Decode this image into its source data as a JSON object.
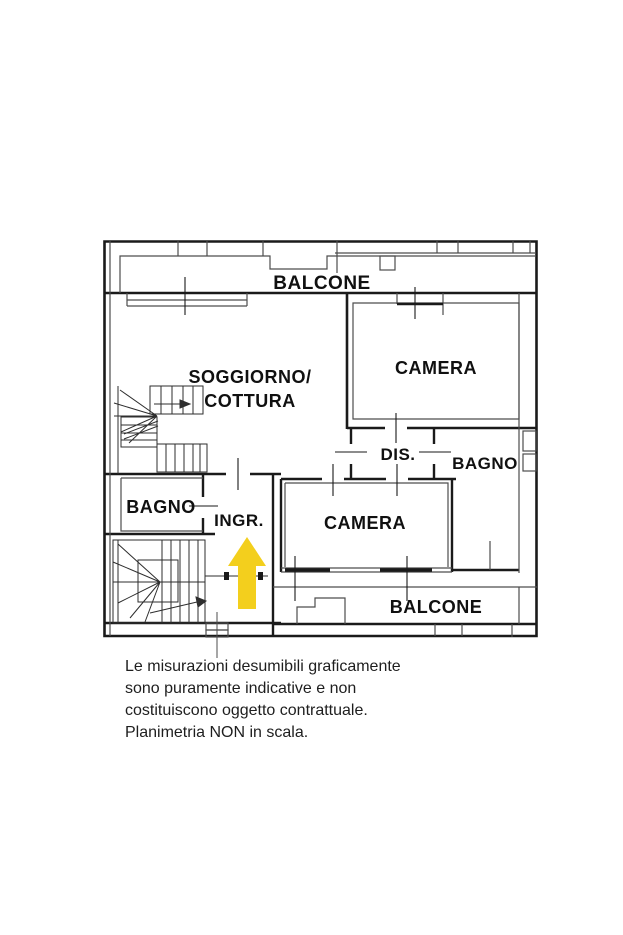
{
  "plan": {
    "labels": {
      "balcone_top": "BALCONE",
      "soggiorno_line1": "SOGGIORNO/",
      "soggiorno_line2": "COTTURA",
      "camera_top": "CAMERA",
      "dis": "DIS.",
      "bagno_right": "BAGNO",
      "bagno_left": "BAGNO",
      "ingresso": "INGR.",
      "camera_bottom": "CAMERA",
      "balcone_bottom": "BALCONE"
    },
    "colors": {
      "wall": "#1a1a1a",
      "thin_line": "#4d4d4d",
      "stair_line": "#2e2e2e",
      "entrance_arrow": "#f3cf1d"
    },
    "icons": {
      "entrance_arrow": "up-arrow"
    }
  },
  "disclaimer": {
    "lines": [
      "Le misurazioni desumibili graficamente",
      "sono puramente indicative e non",
      "costituiscono oggetto contrattuale.",
      "Planimetria NON in scala."
    ]
  }
}
